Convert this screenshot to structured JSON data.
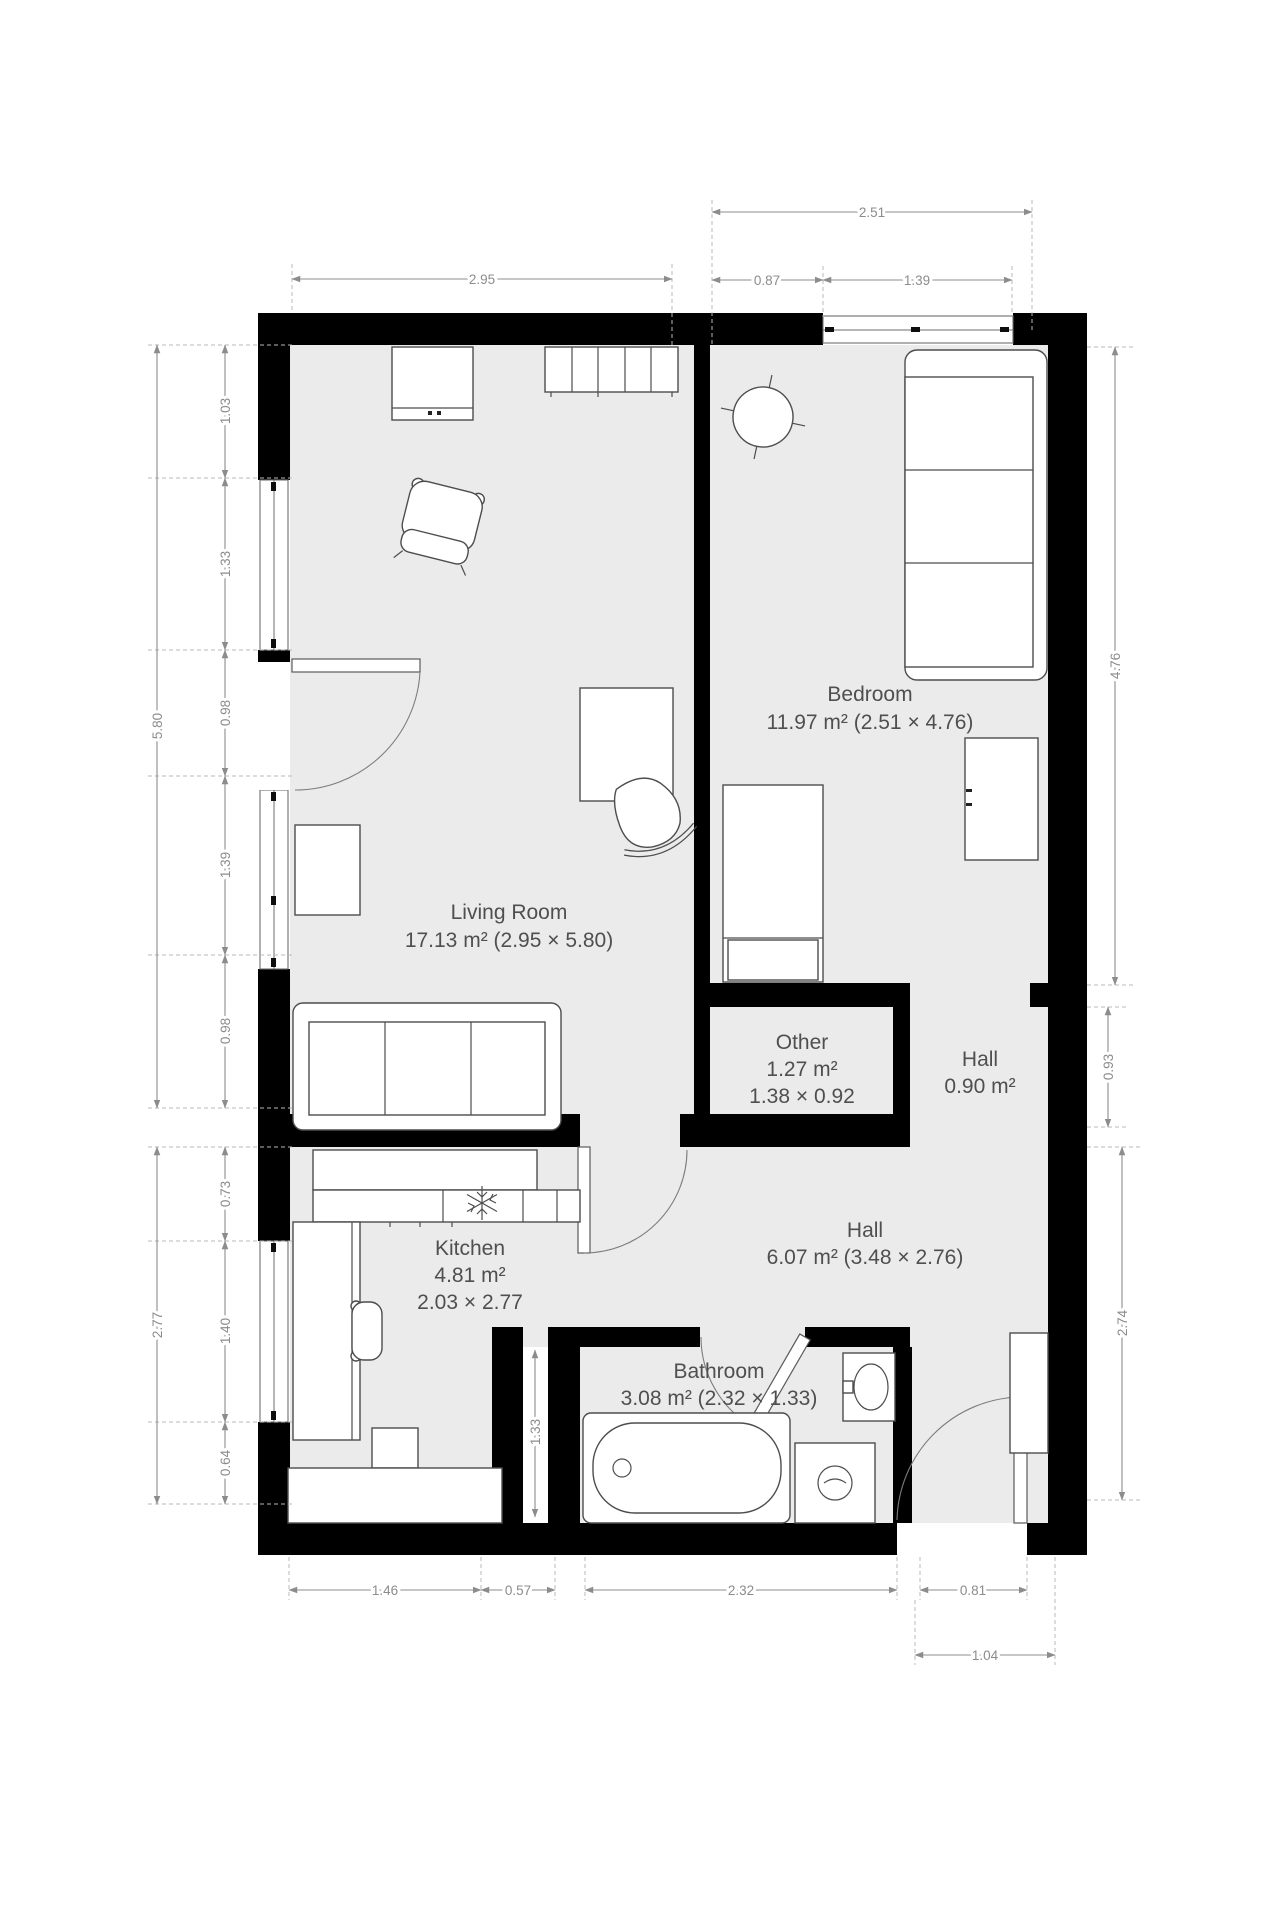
{
  "rooms": {
    "living": {
      "name": "Living Room",
      "line2": "17.13 m² (2.95 × 5.80)"
    },
    "bedroom": {
      "name": "Bedroom",
      "line2": "11.97 m² (2.51 × 4.76)"
    },
    "other": {
      "name": "Other",
      "line2": "1.27 m²",
      "line3": "1.38 × 0.92"
    },
    "hall_small": {
      "name": "Hall",
      "line2": "0.90 m²"
    },
    "hall": {
      "name": "Hall",
      "line2": "6.07 m² (3.48 × 2.76)"
    },
    "kitchen": {
      "name": "Kitchen",
      "line2": "4.81 m²",
      "line3": "2.03 × 2.77"
    },
    "bathroom": {
      "name": "Bathroom",
      "line2": "3.08 m² (2.32 × 1.33)"
    }
  },
  "dims": {
    "top_total": "2.51",
    "top_seg1": "0.87",
    "top_seg2": "1.39",
    "top_living": "2.95",
    "left_total_upper": "5.80",
    "left_seg1": "1.03",
    "left_seg2": "1.33",
    "left_seg3": "0.98",
    "left_seg4": "1.39",
    "left_seg5": "0.98",
    "left_total_lower": "2.77",
    "left_seg6": "0.73",
    "left_seg7": "1.40",
    "left_seg8": "0.64",
    "right_bedroom": "4.76",
    "right_hall_small": "0.93",
    "right_hall": "2.74",
    "bottom_seg1": "1.46",
    "bottom_seg2": "0.57",
    "bottom_seg3": "2.32",
    "bottom_seg4": "0.81",
    "bottom_entry": "1.04",
    "bathroom_width": "1.33"
  },
  "colors": {
    "wall": "#000000",
    "floor": "#ebebeb",
    "dimension": "#8c8c8c",
    "label": "#4f4f4f",
    "background": "#ffffff"
  }
}
